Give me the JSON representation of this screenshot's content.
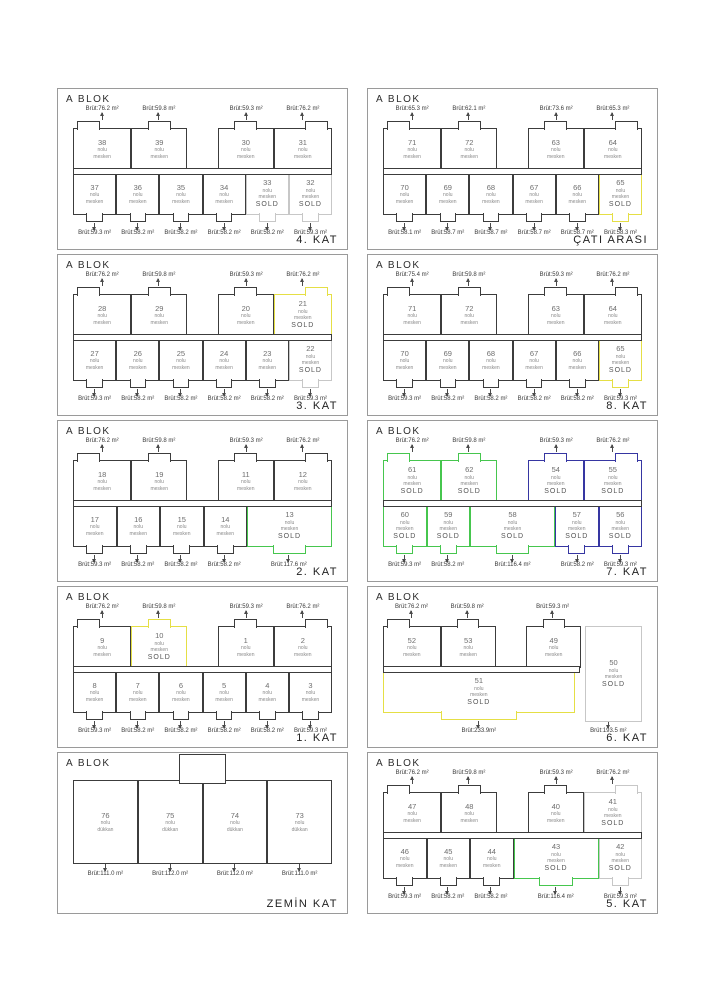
{
  "block_label": "A BLOK",
  "labels": {
    "nolu": "nolu",
    "mesken": "mesken",
    "dukkan": "dükkan",
    "sold": "SOLD"
  },
  "colors": {
    "outline": "#3c3c3c",
    "sold_gray": "#c7c7c7",
    "sold_yellow": "#e5df45",
    "sold_green": "#46c64e",
    "sold_blue": "#3636a2"
  },
  "panels": [
    {
      "floor": "4. KAT",
      "layout": "standard",
      "top": [
        {
          "no": "38",
          "area": "Brüt:76.2 m²",
          "w": 22,
          "b": "l"
        },
        {
          "no": "39",
          "area": "Brüt:59.8 m²",
          "w": 21,
          "b": "c"
        },
        {
          "gap": true,
          "w": 12
        },
        {
          "no": "30",
          "area": "Brüt:59.3 m²",
          "w": 21,
          "b": "c"
        },
        {
          "no": "31",
          "area": "Brüt:76.2 m²",
          "w": 22,
          "b": "r"
        }
      ],
      "bottom": [
        {
          "no": "37",
          "area": "Brüt:59.3 m²",
          "w": 16
        },
        {
          "no": "36",
          "area": "Brüt:58.2 m²",
          "w": 16
        },
        {
          "no": "35",
          "area": "Brüt:58.2 m²",
          "w": 16
        },
        {
          "no": "34",
          "area": "Brüt:58.2 m²",
          "w": 16
        },
        {
          "no": "33",
          "area": "Brüt:58.2 m²",
          "w": 16,
          "c": "gr",
          "s": true
        },
        {
          "no": "32",
          "area": "Brüt:59.3 m²",
          "w": 16,
          "c": "gr",
          "s": true
        }
      ]
    },
    {
      "floor": "ÇATI ARASI",
      "layout": "standard",
      "top": [
        {
          "no": "71",
          "area": "Brüt:65.3 m²",
          "w": 22,
          "b": "l"
        },
        {
          "no": "72",
          "area": "Brüt:62.1 m²",
          "w": 21,
          "b": "c"
        },
        {
          "gap": true,
          "w": 12
        },
        {
          "no": "63",
          "area": "Brüt:73.6 m²",
          "w": 21,
          "b": "c"
        },
        {
          "no": "64",
          "area": "Brüt:65.3 m²",
          "w": 22,
          "b": "r"
        }
      ],
      "bottom": [
        {
          "no": "70",
          "area": "Brüt:58.1 m²",
          "w": 16
        },
        {
          "no": "69",
          "area": "Brüt:58.7 m²",
          "w": 16
        },
        {
          "no": "68",
          "area": "Brüt:58.7 m²",
          "w": 16
        },
        {
          "no": "67",
          "area": "Brüt:58.7 m²",
          "w": 16
        },
        {
          "no": "66",
          "area": "Brüt:58.7 m²",
          "w": 16
        },
        {
          "no": "65",
          "area": "Brüt:58.3 m²",
          "w": 16,
          "c": "y",
          "s": true
        }
      ]
    },
    {
      "floor": "3. KAT",
      "layout": "standard",
      "top": [
        {
          "no": "28",
          "area": "Brüt:76.2 m²",
          "w": 22,
          "b": "l"
        },
        {
          "no": "29",
          "area": "Brüt:59.8 m²",
          "w": 21,
          "b": "c"
        },
        {
          "gap": true,
          "w": 12
        },
        {
          "no": "20",
          "area": "Brüt:59.3 m²",
          "w": 21,
          "b": "c"
        },
        {
          "no": "21",
          "area": "Brüt:76.2 m²",
          "w": 22,
          "b": "r",
          "c": "y",
          "s": true
        }
      ],
      "bottom": [
        {
          "no": "27",
          "area": "Brüt:59.3 m²",
          "w": 16
        },
        {
          "no": "26",
          "area": "Brüt:58.2 m²",
          "w": 16
        },
        {
          "no": "25",
          "area": "Brüt:58.2 m²",
          "w": 16
        },
        {
          "no": "24",
          "area": "Brüt:58.2 m²",
          "w": 16
        },
        {
          "no": "23",
          "area": "Brüt:58.2 m²",
          "w": 16
        },
        {
          "no": "22",
          "area": "Brüt:59.3 m²",
          "w": 16,
          "c": "gr",
          "s": true
        }
      ]
    },
    {
      "floor": "8. KAT",
      "layout": "standard",
      "top": [
        {
          "no": "71",
          "area": "Brüt:75.4 m²",
          "w": 22,
          "b": "l"
        },
        {
          "no": "72",
          "area": "Brüt:59.8 m²",
          "w": 21,
          "b": "c"
        },
        {
          "gap": true,
          "w": 12
        },
        {
          "no": "63",
          "area": "Brüt:59.3 m²",
          "w": 21,
          "b": "c"
        },
        {
          "no": "64",
          "area": "Brüt:76.2 m²",
          "w": 22,
          "b": "r"
        }
      ],
      "bottom": [
        {
          "no": "70",
          "area": "Brüt:59.3 m²",
          "w": 16
        },
        {
          "no": "69",
          "area": "Brüt:58.2 m²",
          "w": 16
        },
        {
          "no": "68",
          "area": "Brüt:58.2 m²",
          "w": 16
        },
        {
          "no": "67",
          "area": "Brüt:58.2 m²",
          "w": 16
        },
        {
          "no": "66",
          "area": "Brüt:58.2 m²",
          "w": 16
        },
        {
          "no": "65",
          "area": "Brüt:59.3 m²",
          "w": 16,
          "c": "y",
          "s": true
        }
      ]
    },
    {
      "floor": "2. KAT",
      "layout": "standard",
      "top": [
        {
          "no": "18",
          "area": "Brüt:76.2 m²",
          "w": 22,
          "b": "l"
        },
        {
          "no": "19",
          "area": "Brüt:59.8 m²",
          "w": 21,
          "b": "c"
        },
        {
          "gap": true,
          "w": 12
        },
        {
          "no": "11",
          "area": "Brüt:59.3 m²",
          "w": 21,
          "b": "c"
        },
        {
          "no": "12",
          "area": "Brüt:76.2 m²",
          "w": 22,
          "b": "r"
        }
      ],
      "bottom": [
        {
          "no": "17",
          "area": "Brüt:59.3 m²",
          "w": 16
        },
        {
          "no": "16",
          "area": "Brüt:58.2 m²",
          "w": 16
        },
        {
          "no": "15",
          "area": "Brüt:58.2 m²",
          "w": 16
        },
        {
          "no": "14",
          "area": "Brüt:58.2 m²",
          "w": 16
        },
        {
          "no": "13",
          "area": "Brüt:117.6 m²",
          "w": 32,
          "c": "g",
          "s": true
        }
      ]
    },
    {
      "floor": "7. KAT",
      "layout": "standard",
      "top": [
        {
          "no": "61",
          "area": "Brüt:76.2 m²",
          "w": 22,
          "b": "l",
          "c": "g",
          "s": true
        },
        {
          "no": "62",
          "area": "Brüt:59.8 m²",
          "w": 21,
          "b": "c",
          "c": "g",
          "s": true
        },
        {
          "gap": true,
          "w": 12
        },
        {
          "no": "54",
          "area": "Brüt:59.3 m²",
          "w": 21,
          "b": "c",
          "c": "b",
          "s": true
        },
        {
          "no": "55",
          "area": "Brüt:76.2 m²",
          "w": 22,
          "b": "r",
          "c": "b",
          "s": true
        }
      ],
      "bottom": [
        {
          "no": "60",
          "area": "Brüt:59.3 m²",
          "w": 16,
          "c": "g",
          "s": true
        },
        {
          "no": "59",
          "area": "Brüt:58.2 m²",
          "w": 16,
          "c": "g",
          "s": true
        },
        {
          "no": "58",
          "area": "Brüt:116.4 m²",
          "w": 32,
          "c": "g",
          "s": true
        },
        {
          "no": "57",
          "area": "Brüt:58.2 m²",
          "w": 16,
          "c": "b",
          "s": true
        },
        {
          "no": "56",
          "area": "Brüt:59.3 m²",
          "w": 16,
          "c": "b",
          "s": true
        }
      ]
    },
    {
      "floor": "1. KAT",
      "layout": "standard",
      "top": [
        {
          "no": "9",
          "area": "Brüt:76.2 m²",
          "w": 22,
          "b": "l"
        },
        {
          "no": "10",
          "area": "Brüt:59.8 m²",
          "w": 21,
          "b": "c",
          "c": "y",
          "s": true
        },
        {
          "gap": true,
          "w": 12
        },
        {
          "no": "1",
          "area": "Brüt:59.3 m²",
          "w": 21,
          "b": "c"
        },
        {
          "no": "2",
          "area": "Brüt:76.2 m²",
          "w": 22,
          "b": "r"
        }
      ],
      "bottom": [
        {
          "no": "8",
          "area": "Brüt:59.3 m²",
          "w": 16
        },
        {
          "no": "7",
          "area": "Brüt:58.2 m²",
          "w": 16
        },
        {
          "no": "6",
          "area": "Brüt:58.2 m²",
          "w": 16
        },
        {
          "no": "5",
          "area": "Brüt:58.2 m²",
          "w": 16
        },
        {
          "no": "4",
          "area": "Brüt:58.2 m²",
          "w": 16
        },
        {
          "no": "3",
          "area": "Brüt:59.3 m²",
          "w": 16
        }
      ]
    },
    {
      "floor": "6. KAT",
      "layout": "kat6",
      "top": [
        {
          "no": "52",
          "area": "Brüt:76.2 m²",
          "w": 22,
          "b": "l"
        },
        {
          "no": "53",
          "area": "Brüt:59.8 m²",
          "w": 21,
          "b": "c"
        },
        {
          "gap": true,
          "w": 12
        },
        {
          "no": "49",
          "area": "Brüt:59.3 m²",
          "w": 21,
          "b": "c"
        },
        {
          "gap": true,
          "w": 24
        }
      ],
      "mid": {
        "no": "51",
        "area": "Brüt:233.9m²",
        "w": 74,
        "c": "y",
        "s": true
      },
      "side": {
        "no": "50",
        "area": "Brüt:193.5 m²",
        "w": 26,
        "c": "gr",
        "s": true
      }
    },
    {
      "floor": "ZEMİN KAT",
      "layout": "zemin",
      "kind": "dukkan",
      "units": [
        {
          "no": "76",
          "area": "Brüt:111.0 m²",
          "w": 25
        },
        {
          "no": "75",
          "area": "Brüt:112.0 m²",
          "w": 25
        },
        {
          "no": "74",
          "area": "Brüt:112.0 m²",
          "w": 25
        },
        {
          "no": "73",
          "area": "Brüt:111.0 m²",
          "w": 25
        }
      ]
    },
    {
      "floor": "5. KAT",
      "layout": "standard",
      "top": [
        {
          "no": "47",
          "area": "Brüt:76.2 m²",
          "w": 22,
          "b": "l"
        },
        {
          "no": "48",
          "area": "Brüt:59.8 m²",
          "w": 21,
          "b": "c"
        },
        {
          "gap": true,
          "w": 12
        },
        {
          "no": "40",
          "area": "Brüt:59.3 m²",
          "w": 21,
          "b": "c"
        },
        {
          "no": "41",
          "area": "Brüt:76.2 m²",
          "w": 22,
          "b": "r",
          "c": "gr",
          "s": true
        }
      ],
      "bottom": [
        {
          "no": "46",
          "area": "Brüt:59.3 m²",
          "w": 16
        },
        {
          "no": "45",
          "area": "Brüt:58.2 m²",
          "w": 16
        },
        {
          "no": "44",
          "area": "Brüt:58.2 m²",
          "w": 16
        },
        {
          "no": "43",
          "area": "Brüt:116.4 m²",
          "w": 32,
          "c": "g",
          "s": true
        },
        {
          "no": "42",
          "area": "Brüt:59.3 m²",
          "w": 16,
          "c": "gr",
          "s": true
        }
      ]
    }
  ]
}
